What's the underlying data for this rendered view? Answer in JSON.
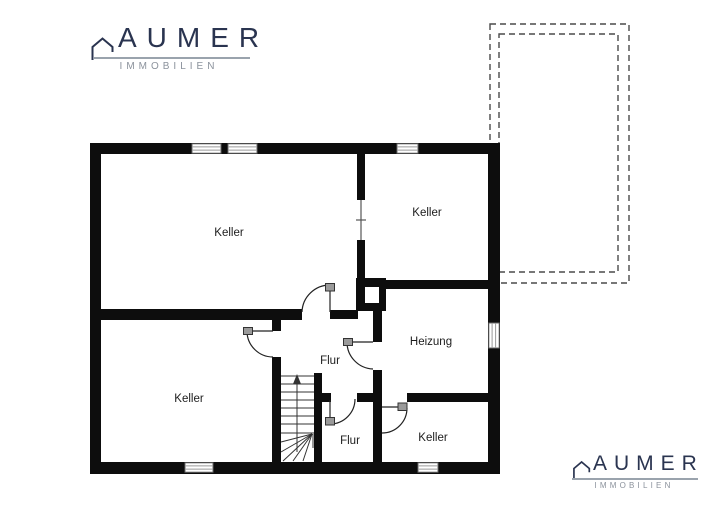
{
  "branding": {
    "name": "AUMER",
    "subtitle": "IMMOBILIEN"
  },
  "colors": {
    "wall_black": "#0d0d0d",
    "brand_navy": "#2a3450",
    "brand_gray": "#8b929c",
    "divider_gray": "#9aa3ad",
    "window_line_gray": "#9a9a9a"
  },
  "floor_plan": {
    "room_labels": {
      "keller_main": "Keller",
      "keller_top_right": "Keller",
      "heizung": "Heizung",
      "flur_mid": "Flur",
      "keller_bottom_left": "Keller",
      "flur_bottom": "Flur",
      "keller_bottom_right": "Keller"
    }
  }
}
